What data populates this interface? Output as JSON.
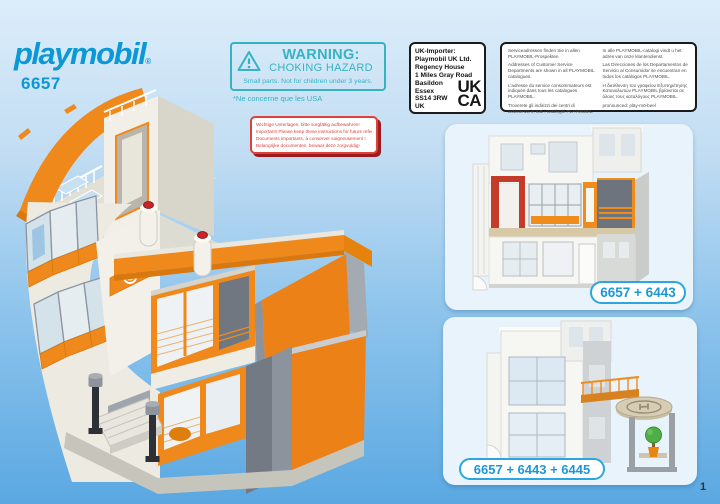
{
  "brand": {
    "logo_text": "playmobil",
    "registered_mark": "®",
    "set_number": "6657",
    "brand_color": "#0a99d6"
  },
  "warning_box": {
    "title": "WARNING:",
    "subtitle": "CHOKING HAZARD",
    "detail": "Small parts. Not for children under 3 years.",
    "footnote": "*Ne concerne que les USA",
    "color": "#35b3c3"
  },
  "keep_instructions_box": {
    "color": "#e0403a",
    "lines": [
      "Wichtige Unterlagen, bitte sorgfältig aufbewahren!",
      "Important! Please keep these instructions for future reference!",
      "Documents importants, à conserver soigneusement !",
      "Belangrijke documenten, bewaar deze zorgvuldig!"
    ]
  },
  "uk_importer_box": {
    "lines": [
      "UK-Importer:",
      "Playmobil UK Ltd.",
      "Regency House",
      "1 Miles Gray Road",
      "Basildon",
      "Essex",
      "SS14 3RW",
      "UK"
    ],
    "ukca_mark": {
      "line1": "UK",
      "line2": "CA"
    }
  },
  "service_box": {
    "col_left": [
      "Serviceadressen finden Sie in allen PLAYMOBIL-Prospekten",
      "Addresses of Customer Service Departments are shown in all PLAYMOBIL catalogues.",
      "L'adresse du service consommateurs est indiquée dans tous les catalogues PLAYMOBIL.",
      "Troverete gli indirizzi dei centri di assistenza in tutti i cataloghi PLAYMOBIL."
    ],
    "col_right": [
      "In alle PLAYMOBIL-catalogi vindt u het adres van onze klantendienst.",
      "Las Direcciones de los Departamentos de Servicio al Consumidor se encuentran en todos los catálogos PLAYMOBIL.",
      "Η διεύθυνση του γραφείου Εξυπηρέτησης Καταναλωτών PLAYMOBIL βρίσκεται σε όλους τους καταλόγους PLAYMOBIL.",
      "pronounced: pläy-mō-beel"
    ]
  },
  "inset_cards": [
    {
      "label": "6657 + 6443"
    },
    {
      "label": "6657 + 6443 + 6445"
    }
  ],
  "page": {
    "number": "1"
  },
  "colors": {
    "accent_orange": "#f0891c",
    "pill_blue": "#2aa7e0",
    "background_sky_blue": "#5aa8e2"
  }
}
